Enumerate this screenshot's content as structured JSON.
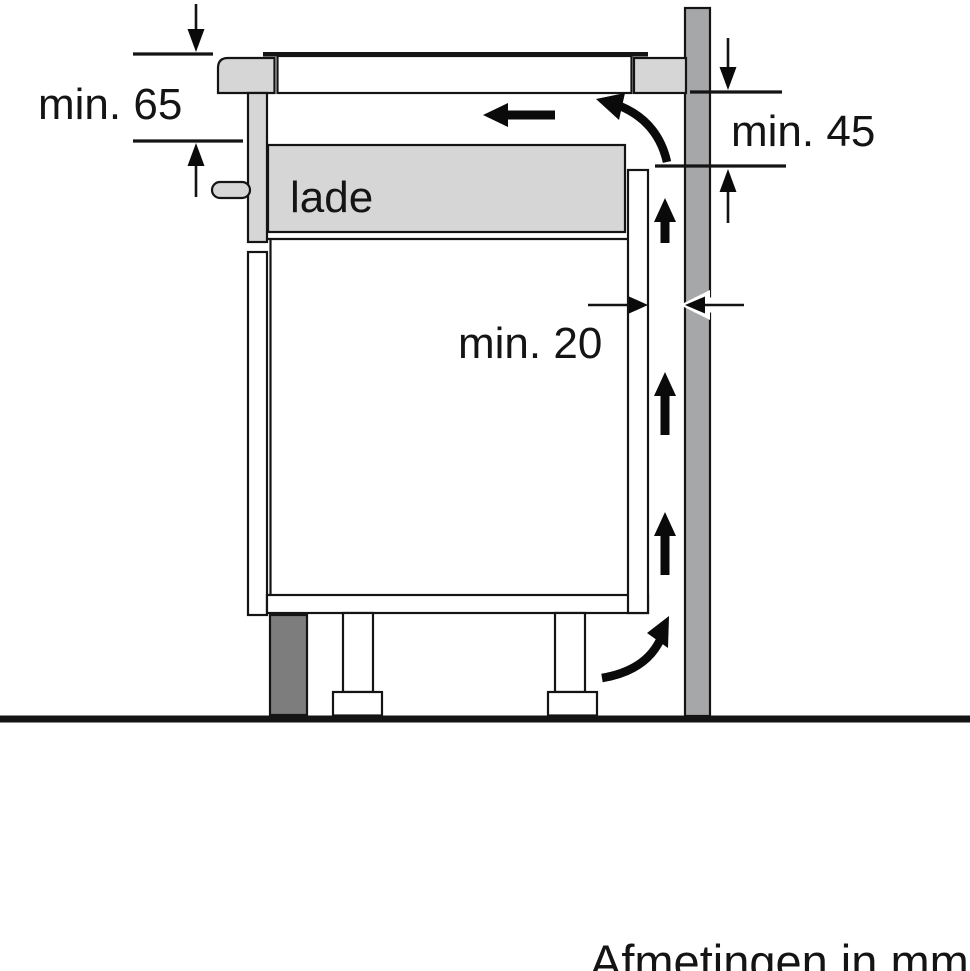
{
  "diagram": {
    "footnote": "Afmetingen in mm",
    "drawer_label": "lade",
    "dimensions": {
      "worktop_to_drawer": "min. 65",
      "worktop_to_back_clearance": "min. 45",
      "wall_gap": "min. 20"
    },
    "colors": {
      "background": "#ffffff",
      "line": "#141414",
      "arrow": "#0a0a0a",
      "wall": "#a5a7a8",
      "plinth": "#7d7d7d",
      "panel": "#d6d6d6",
      "cabinet": "#ffffff"
    }
  }
}
